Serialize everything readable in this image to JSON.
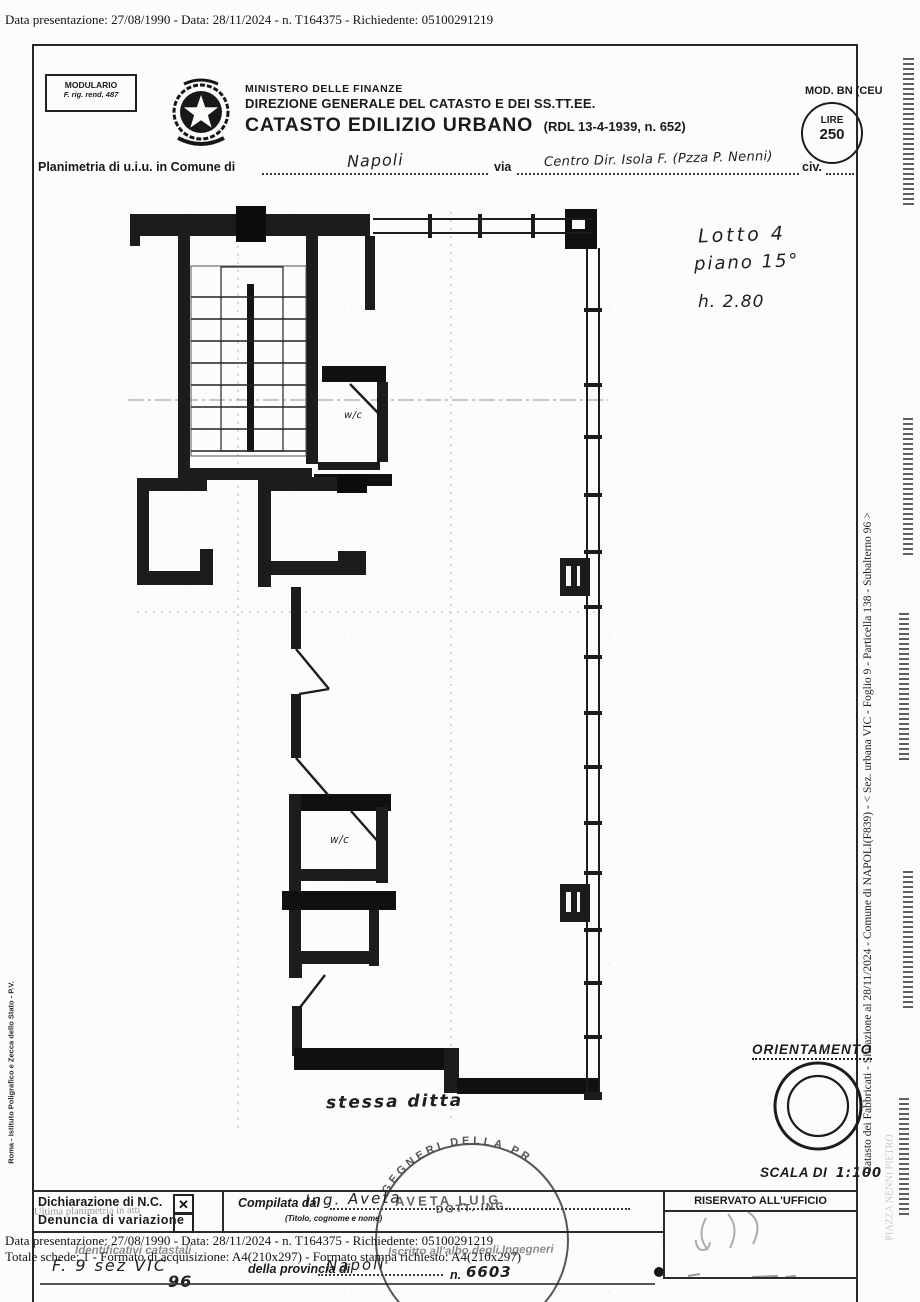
{
  "top_line": "Data presentazione: 27/08/1990 - Data: 28/11/2024 - n. T164375 - Richiedente: 05100291219",
  "header": {
    "modulario1": "MODULARIO",
    "modulario2": "F. rig. rend. 487",
    "ministero": "MINISTERO DELLE FINANZE",
    "direzione": "DIREZIONE GENERALE DEL CATASTO E DEI SS.TT.EE.",
    "title": "CATASTO EDILIZIO URBANO",
    "title_suffix": "(RDL 13-4-1939, n. 652)",
    "mod_label": "MOD. BN (CEU",
    "lire_label": "LIRE",
    "lire_value": "250"
  },
  "location": {
    "prefix": "Planimetria di u.i.u. in Comune di",
    "comune": "Napoli",
    "via_label": "via",
    "via_value": "Centro Dir. Isola F. (Pzza P. Nenni)",
    "civ_label": "civ."
  },
  "plan": {
    "lotto": "Lotto 4",
    "piano": "piano 15°",
    "height": "h. 2.80",
    "wc_upper": "w/c",
    "wc_lower": "w/c",
    "stessa_ditta": "stessa ditta"
  },
  "orientation": {
    "title": "ORIENTAMENTO",
    "scala_label": "SCALA DI",
    "scala_value": "1:100"
  },
  "margins": {
    "right_vertical": "Catasto dei Fabbricati - Situazione al 28/11/2024 - Comune di NAPOLI(F839) - < Sez. urbana VIC -  Foglio 9 - Particella  138 - Subalterno 96 >",
    "right_vertical_faint": "PIAZZA NENNI PIETRO",
    "left_vertical": "Roma - Istituto Poligrafico e Zecca dello Stato - P.V."
  },
  "footer": {
    "dichiarazione": "Dichiarazione di N.C.",
    "ultima": "Ultima planimetria in atti",
    "denuncia": "Denuncia di variazione",
    "check_glyph": "✕",
    "compilata_label": "Compilata dal",
    "compilata_hand": "Ing. Aveta",
    "compilata_stamp": "AVETA LUIG",
    "titolo_note": "(Titolo, cognome e nome)",
    "riservato": "RISERVATO ALL'UFFICIO",
    "data_line": "Data presentazione: 27/08/1990 - Data: 28/11/2024 - n. T164375 - Richiedente: 05100291219",
    "totale_line": "Totale schede: 1 - Formato di acquisizione: A4(210x297) - Formato stampa richiesto: A4(210x297)",
    "identificativi": "Identificativi catastali",
    "albo": "Iscritto all'albo degli Ingegneri",
    "hand_foglio": "F. 9 sez VIC",
    "hand_sub": "96",
    "provincia_label": "della provincia di",
    "provincia_hand": "Napoli",
    "n_label": "n.",
    "n_value": "6603",
    "stamp_arc": "GEGNERI DELLA PR",
    "stamp_line2": "DOTT. ING."
  }
}
